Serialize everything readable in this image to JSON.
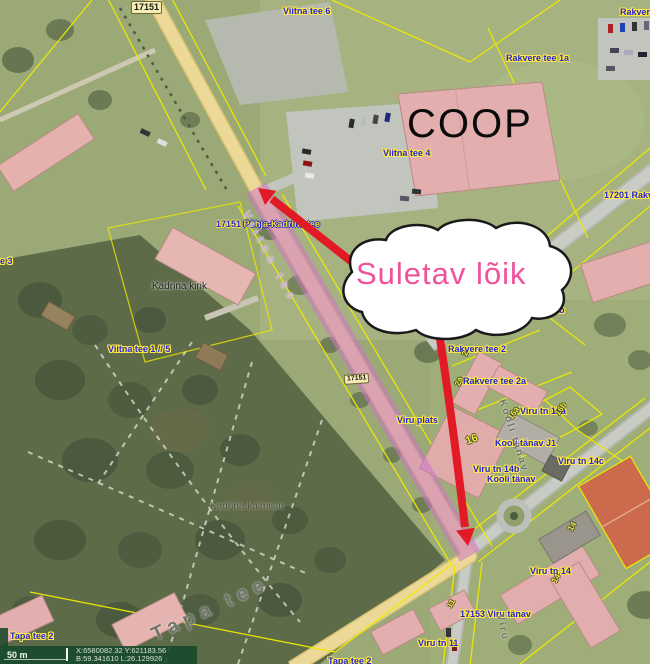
{
  "map": {
    "callout": {
      "text": "Suletav lõik"
    },
    "route_badges": {
      "top": "17151",
      "mid": "17151"
    },
    "road_label": {
      "number": "17151",
      "name": "Põhja-Kadrina tee"
    },
    "labels": {
      "viitna_tee_6": "Viitna tee 6",
      "rakvere_cut": "Rakvere",
      "rakvere_tee_1a": "Rakvere tee 1a",
      "coop": "COOP",
      "viitna_tee_4": "Viitna tee 4",
      "r17201": "17201 Rakv",
      "kadrina_kirik": "Kadrina kirik",
      "tee_3": "e 3",
      "viitna_tee_1_5": "Viitna tee 1 // 5",
      "kadrina_kalmistu": "Kadrina kalmistu",
      "rakvere_tee_2b": "Rakvere tee 2b",
      "rakvere_tee_2": "Rakvere tee 2",
      "rakvere_tee_2a": "Rakvere tee 2a",
      "viru_plats": "Viru plats",
      "viru_tn_16a": "Viru tn 16a",
      "kooli_tanav_j1": "Kooli tänav J1",
      "viru_tn_14c": "Viru tn 14c",
      "viru_tn_14b": "Viru tn 14b",
      "kooli_tanav": "Kooli tänav",
      "viru_tn_14": "Viru tn 14",
      "v17153": "17153 Viru tänav",
      "viru_tn_11": "Viru tn 11",
      "tapa_tee_2": "Tapa tee 2",
      "tapa_tee_2b": "Tapa tee 2"
    },
    "watermarks": {
      "viitna_tee": "Viitna tee",
      "tapa_tee": "Tapa tee",
      "kooli_tanav": "Kooli tänav",
      "viru": "Viru"
    },
    "parcels": {
      "p2": "2",
      "p2a": "2a",
      "p16": "16",
      "p16a": "16a",
      "p16b": "16b",
      "p14a": "14",
      "p14b": "14",
      "p11": "11"
    },
    "scalebar": {
      "distance": "50 m",
      "coord_xy": "X:6580082.32 Y:621183.56",
      "coord_bl": "B:59.341610 L:26.129926"
    },
    "colors": {
      "closure_pink": "#ce74c8",
      "arrow_red": "#e21a25",
      "callout_text": "#ee539c",
      "cadastral_yellow": "#ecea00",
      "label_blue": "#2526cf"
    }
  }
}
